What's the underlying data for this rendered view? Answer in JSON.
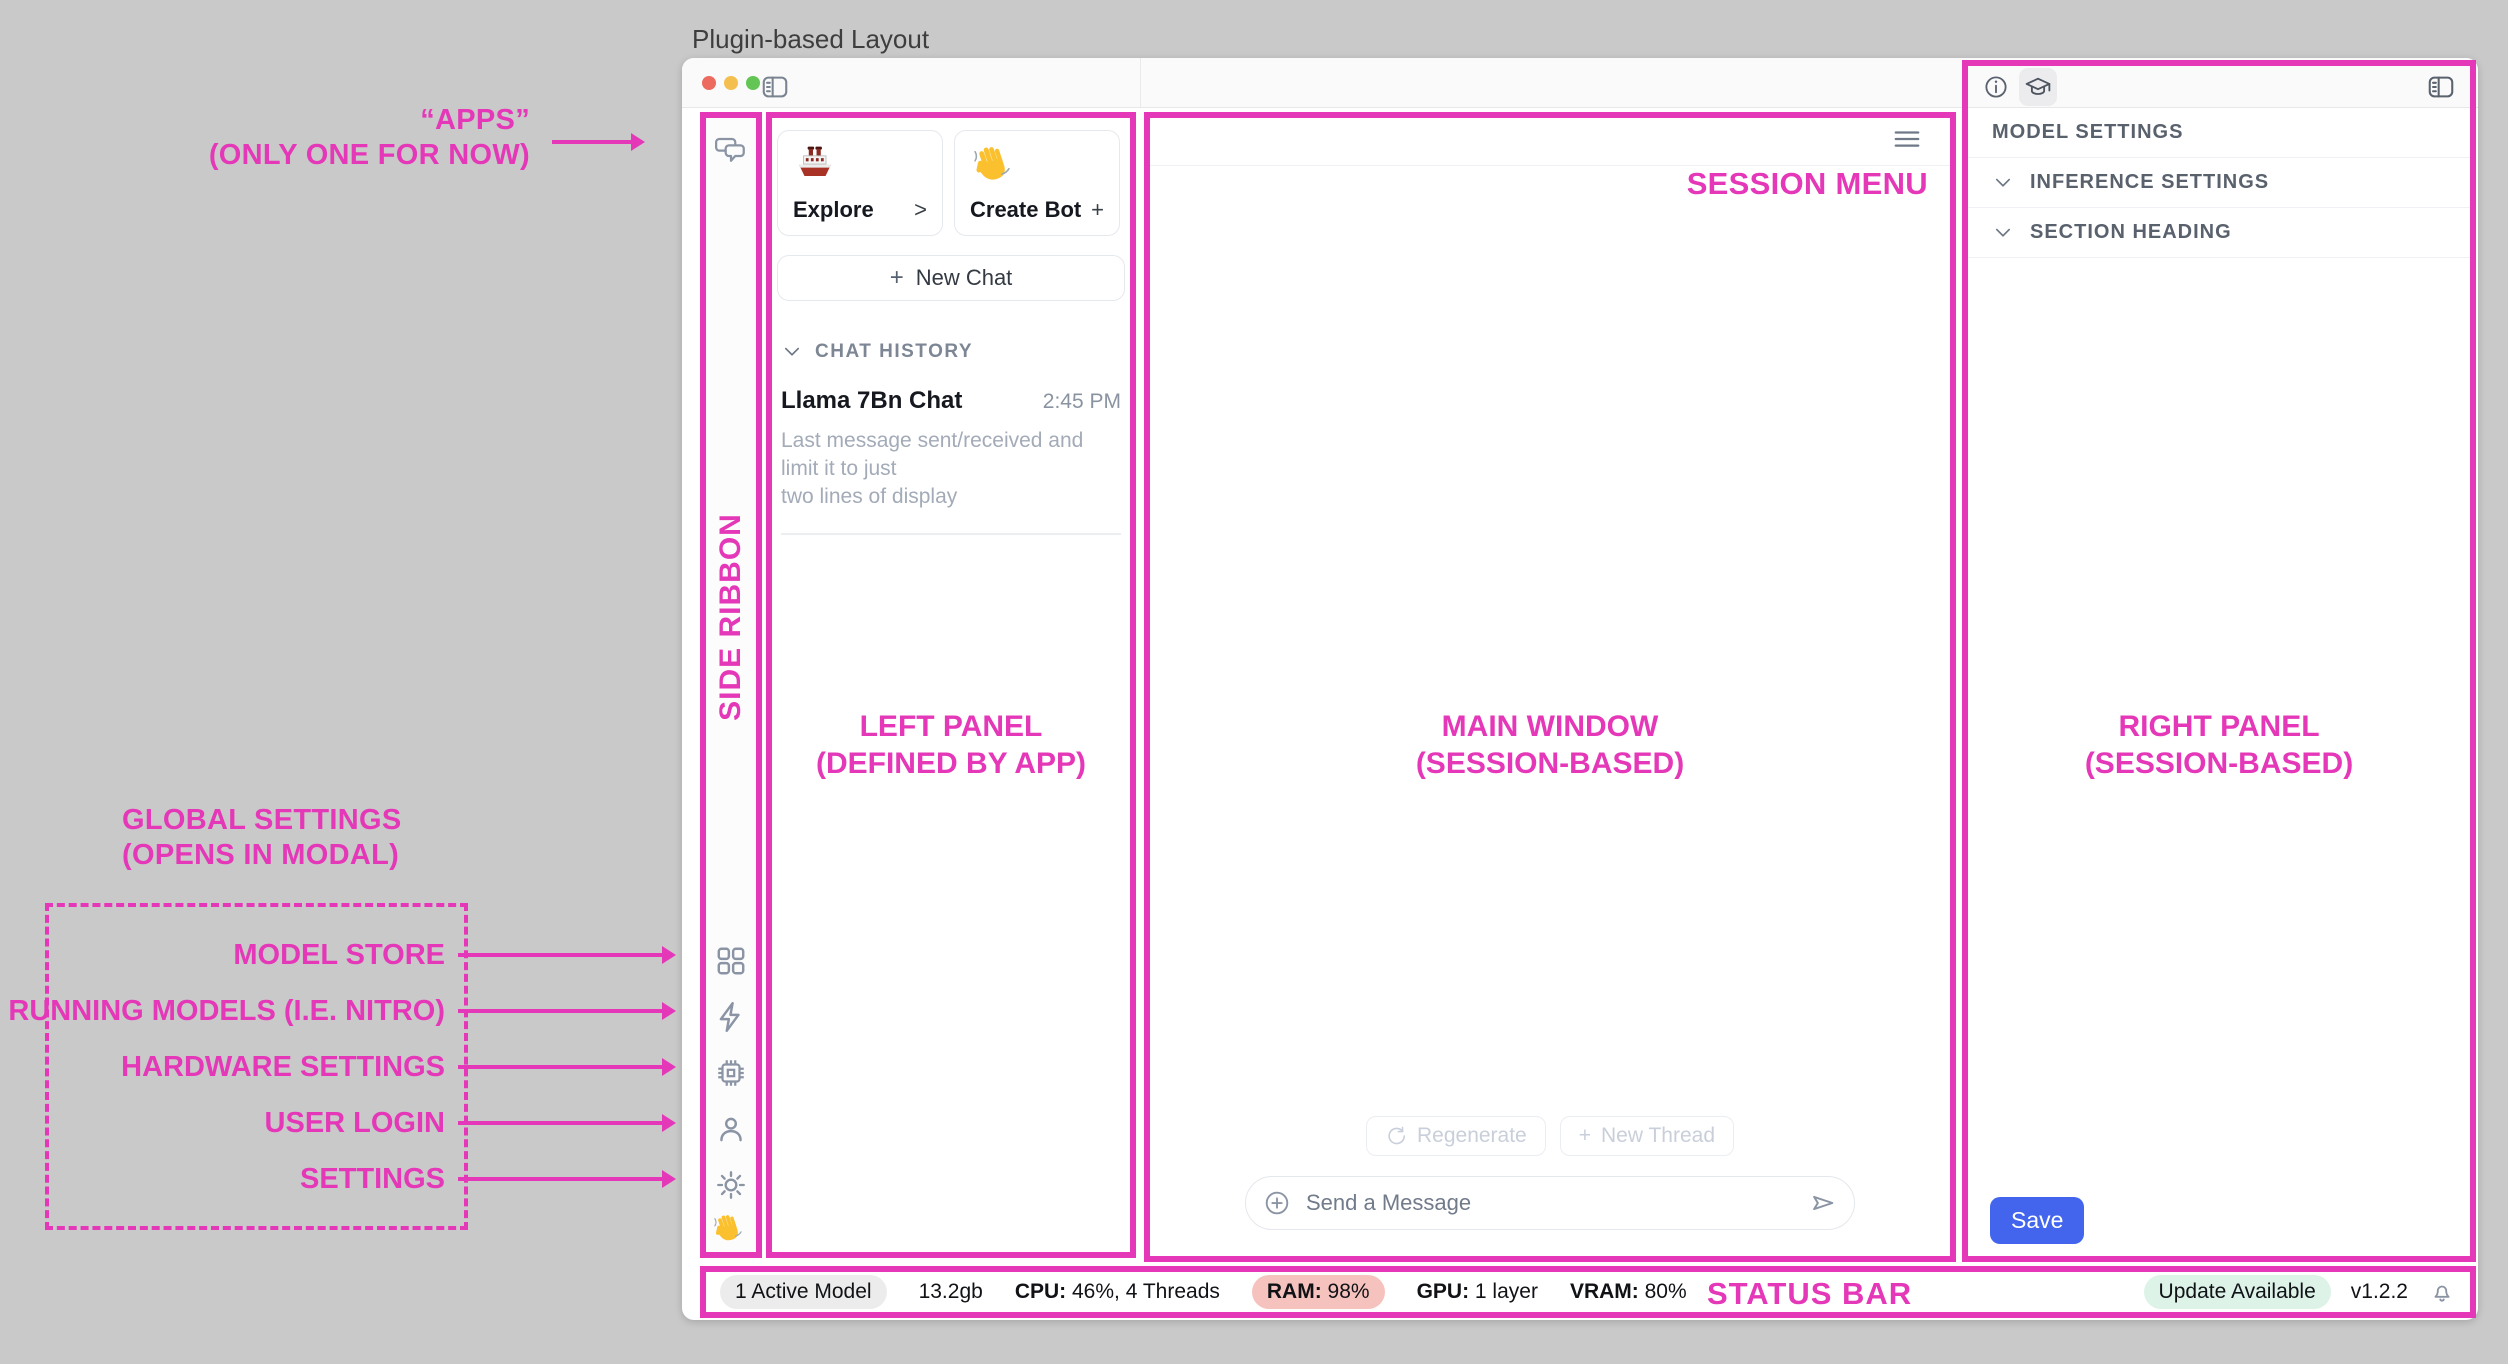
{
  "page_title": "Plugin-based Layout",
  "annotations": {
    "apps_line1": "“APPS”",
    "apps_line2": "(ONLY ONE FOR NOW)",
    "side_ribbon": "SIDE RIBBON",
    "left_panel_line1": "LEFT PANEL",
    "left_panel_line2": "(DEFINED BY APP)",
    "main_window_line1": "MAIN WINDOW",
    "main_window_line2": "(SESSION-BASED)",
    "right_panel_line1": "RIGHT PANEL",
    "right_panel_line2": "(SESSION-BASED)",
    "session_menu": "SESSION MENU",
    "status_bar": "STATUS BAR",
    "global_settings_line1": "GLOBAL SETTINGS",
    "global_settings_line2": "(OPENS IN MODAL)",
    "ribbon_labels": [
      "MODEL STORE",
      "RUNNING MODELS (I.E. NITRO)",
      "HARDWARE SETTINGS",
      "USER LOGIN",
      "SETTINGS"
    ]
  },
  "left_panel": {
    "cards": [
      {
        "icon": "ship-emoji",
        "label": "Explore",
        "action": ">"
      },
      {
        "icon": "wave-emoji",
        "label": "Create Bot",
        "action": "+"
      }
    ],
    "new_chat_plus": "+",
    "new_chat_label": "New Chat",
    "history_header": "CHAT HISTORY",
    "history": [
      {
        "title": "Llama 7Bn Chat",
        "time": "2:45 PM",
        "preview_line1": "Last message sent/received and limit it to just",
        "preview_line2": "two lines of display"
      }
    ]
  },
  "main_window": {
    "regenerate_label": "Regenerate",
    "new_thread_plus": "+",
    "new_thread_label": "New Thread",
    "input_placeholder": "Send a Message"
  },
  "right_panel": {
    "sections": [
      "MODEL SETTINGS",
      "INFERENCE SETTINGS",
      "SECTION HEADING"
    ],
    "save_label": "Save"
  },
  "status_bar": {
    "active_model": "1 Active Model",
    "size": "13.2gb",
    "cpu_label": "CPU:",
    "cpu_value": "46%, 4 Threads",
    "ram_label": "RAM:",
    "ram_value": "98%",
    "gpu_label": "GPU:",
    "gpu_value": "1 layer",
    "vram_label": "VRAM:",
    "vram_value": "80%",
    "update_label": "Update Available",
    "version": "v1.2.2"
  },
  "colors": {
    "annotation_magenta": "#E438B8",
    "save_button_blue": "#4365ED",
    "ram_warning_pill": "#F6C2BE",
    "update_pill_green": "#DDF3E7",
    "traffic_red": "#EC6A5E",
    "traffic_yellow": "#F5BF4F",
    "traffic_green": "#62C554"
  }
}
